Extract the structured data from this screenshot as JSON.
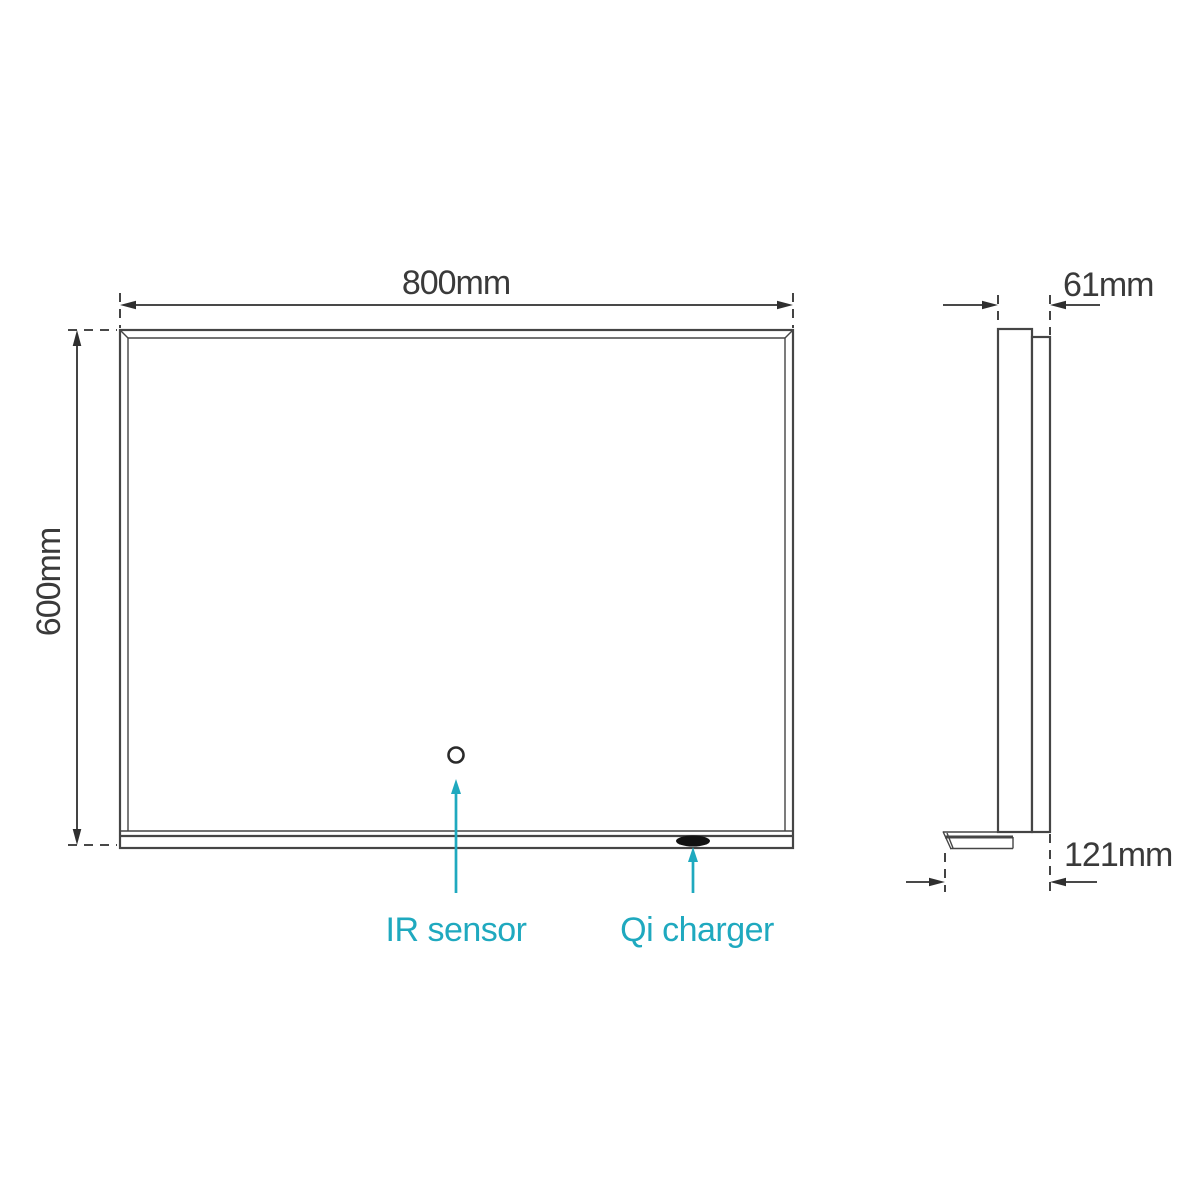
{
  "diagram": {
    "kind": "technical-dimension-drawing",
    "views": {
      "front": {
        "width": {
          "value": 800,
          "unit": "mm",
          "label": "800mm"
        },
        "height": {
          "value": 600,
          "unit": "mm",
          "label": "600mm"
        },
        "features": [
          {
            "id": "ir-sensor",
            "label": "IR sensor"
          },
          {
            "id": "qi-charger",
            "label": "Qi charger"
          }
        ]
      },
      "side": {
        "depth": {
          "value": 61,
          "unit": "mm",
          "label": "61mm"
        },
        "depth_with_shelf": {
          "value": 121,
          "unit": "mm",
          "label": "121mm"
        }
      }
    }
  },
  "colors": {
    "background": "#ffffff",
    "outline": "#454545",
    "dimension": "#2f2f2f",
    "text": "#3a3a3a",
    "accent": "#1fa9bf",
    "charger_fill": "#111111"
  }
}
